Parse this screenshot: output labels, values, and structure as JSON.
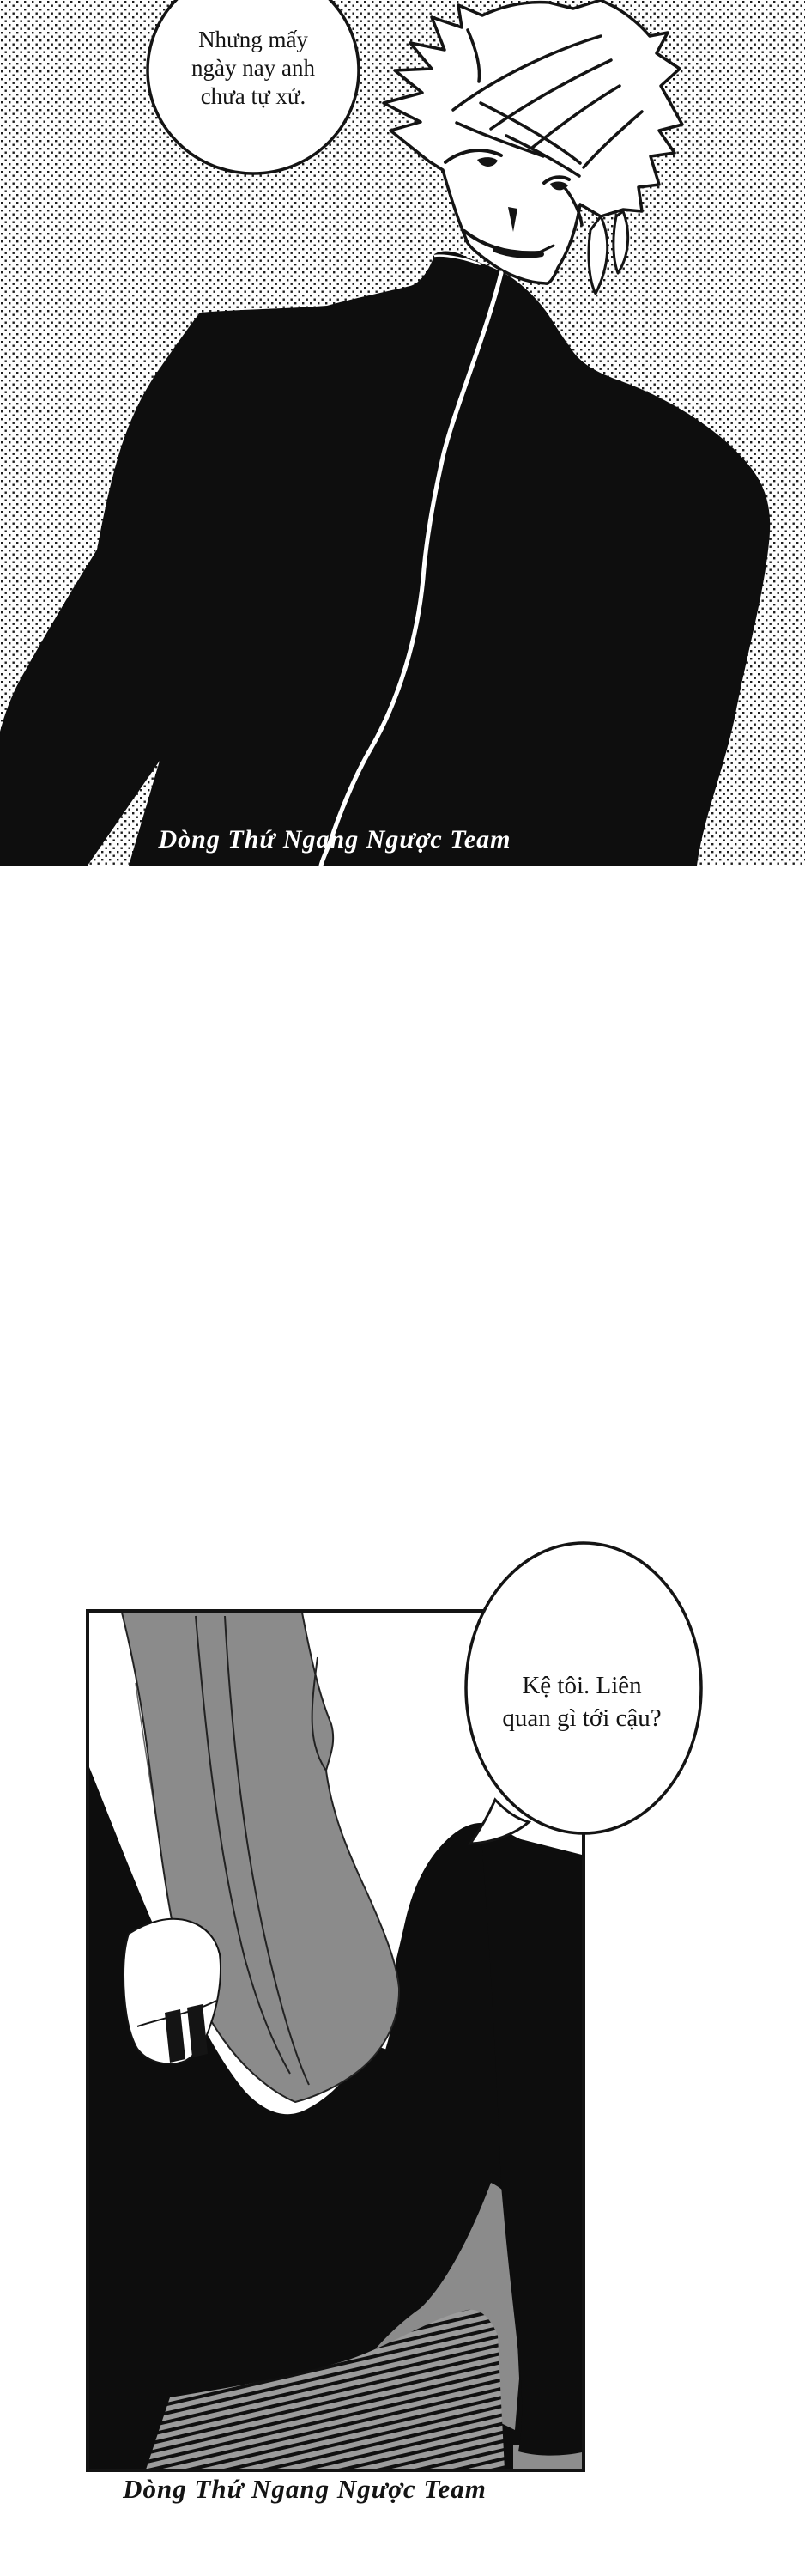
{
  "comic": {
    "panel1": {
      "bubble": {
        "lines": [
          "Nhưng mấy",
          "ngày nay anh",
          "chưa tự xử."
        ]
      },
      "watermark": "Dòng Thứ Ngang Ngược Team"
    },
    "panel2": {
      "bubble": {
        "lines": [
          "Kệ tôi. Liên",
          "quan gì tới cậu?"
        ]
      },
      "watermark": "Dòng Thứ Ngang Ngược Team"
    },
    "colors": {
      "ink": "#141414",
      "paper": "#ffffff",
      "garment_gray": "#8b8b8b",
      "floor_gray": "#9a9a9a"
    }
  }
}
